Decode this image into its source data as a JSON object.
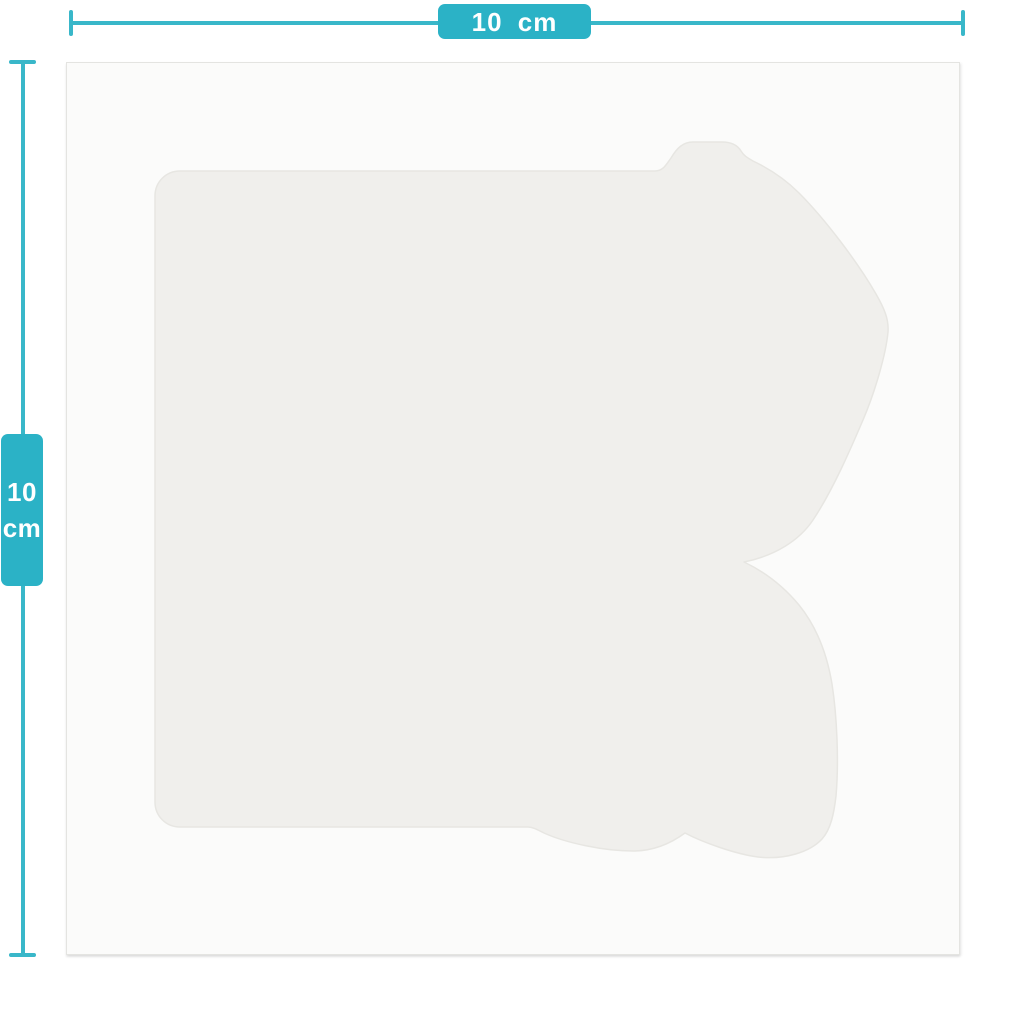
{
  "canvas": {
    "width_px": 1024,
    "height_px": 1024
  },
  "colors": {
    "accent": "#2bb2c6",
    "dimension_line": "#39b7c9",
    "badge_text": "#ffffff",
    "background": "#ffffff",
    "sheet_fill": "#fbfbfa",
    "sheet_edge": "#e4e4e1",
    "shape_fill": "#f0efec",
    "shape_stroke": "#e7e6e2"
  },
  "dimensions": {
    "horizontal": {
      "label": "10 cm"
    },
    "vertical": {
      "value": "10",
      "unit": "cm"
    }
  }
}
